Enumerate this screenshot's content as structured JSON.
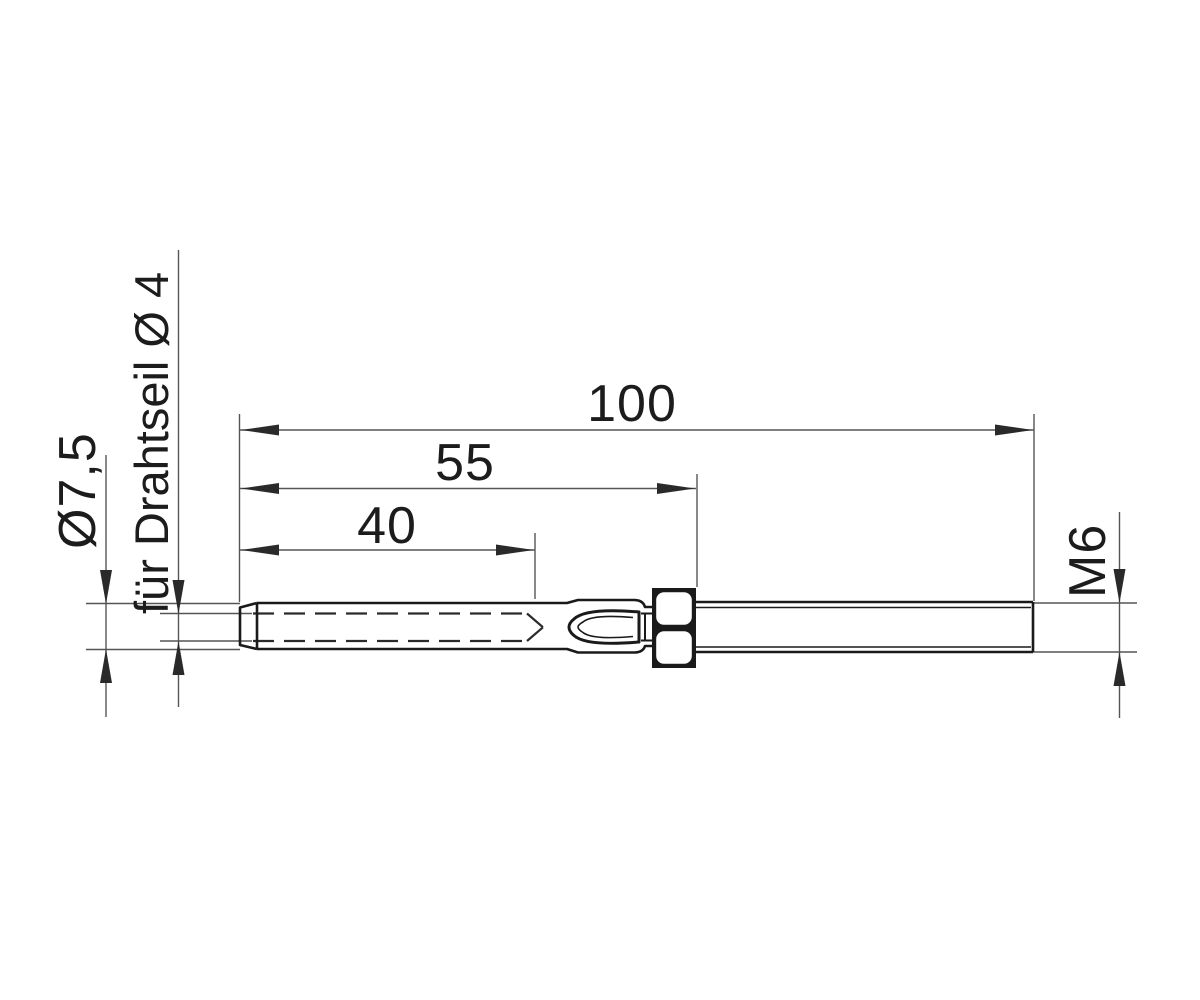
{
  "drawing": {
    "type": "technical-dimension-drawing",
    "subject": "swage-stud-wire-rope-terminal-with-hex-nut-and-threaded-rod",
    "labels": {
      "overall_length": "100",
      "length_to_nut": "55",
      "bore_depth": "40",
      "sleeve_diameter": "Ø7,5",
      "wire_rope_note": "für Drahtseil Ø 4",
      "thread_size": "M6"
    },
    "colors": {
      "background": "#ffffff",
      "part_outline": "#1a1a1a",
      "dimension_lines": "#555555",
      "arrow_fill": "#2a2a2a"
    }
  }
}
